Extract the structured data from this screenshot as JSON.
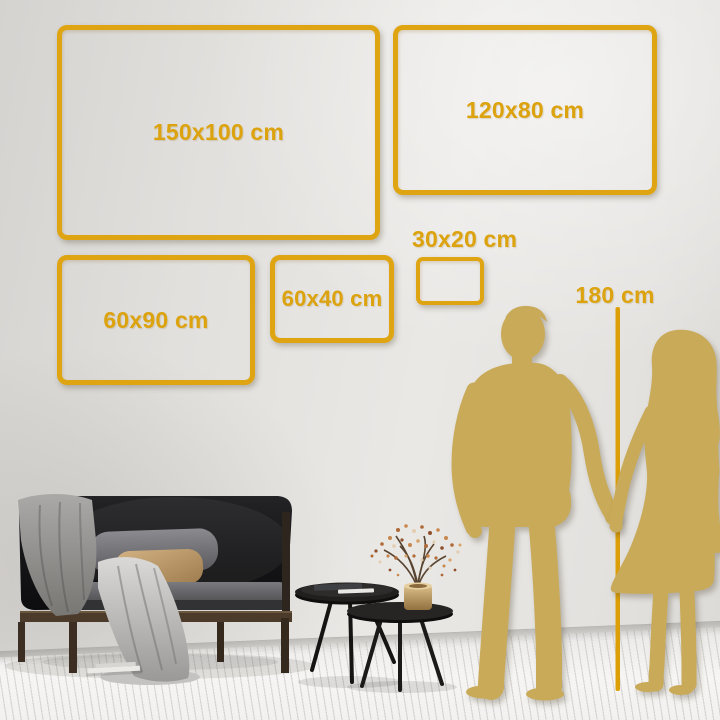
{
  "meta": {
    "title": "Wall art size comparison guide"
  },
  "accent": {
    "frame_gold": "#dfa412",
    "label_gold": "#dca30e",
    "silhouette_gold": "#c9aa58"
  },
  "size_guide": {
    "frames": [
      {
        "id": "150x100",
        "label": "150x100 cm"
      },
      {
        "id": "120x80",
        "label": "120x80 cm"
      },
      {
        "id": "60x90",
        "label": "60x90 cm"
      },
      {
        "id": "60x40",
        "label": "60x40 cm"
      },
      {
        "id": "30x20",
        "label": "30x20 cm"
      }
    ],
    "height_reference": {
      "label": "180 cm"
    }
  },
  "scene": {
    "illustrations": [
      "man-silhouette",
      "woman-silhouette",
      "height-ruler-line",
      "sofa",
      "blanket",
      "pillows",
      "coffee-tables",
      "books",
      "vase-plant",
      "plank-floor"
    ]
  }
}
